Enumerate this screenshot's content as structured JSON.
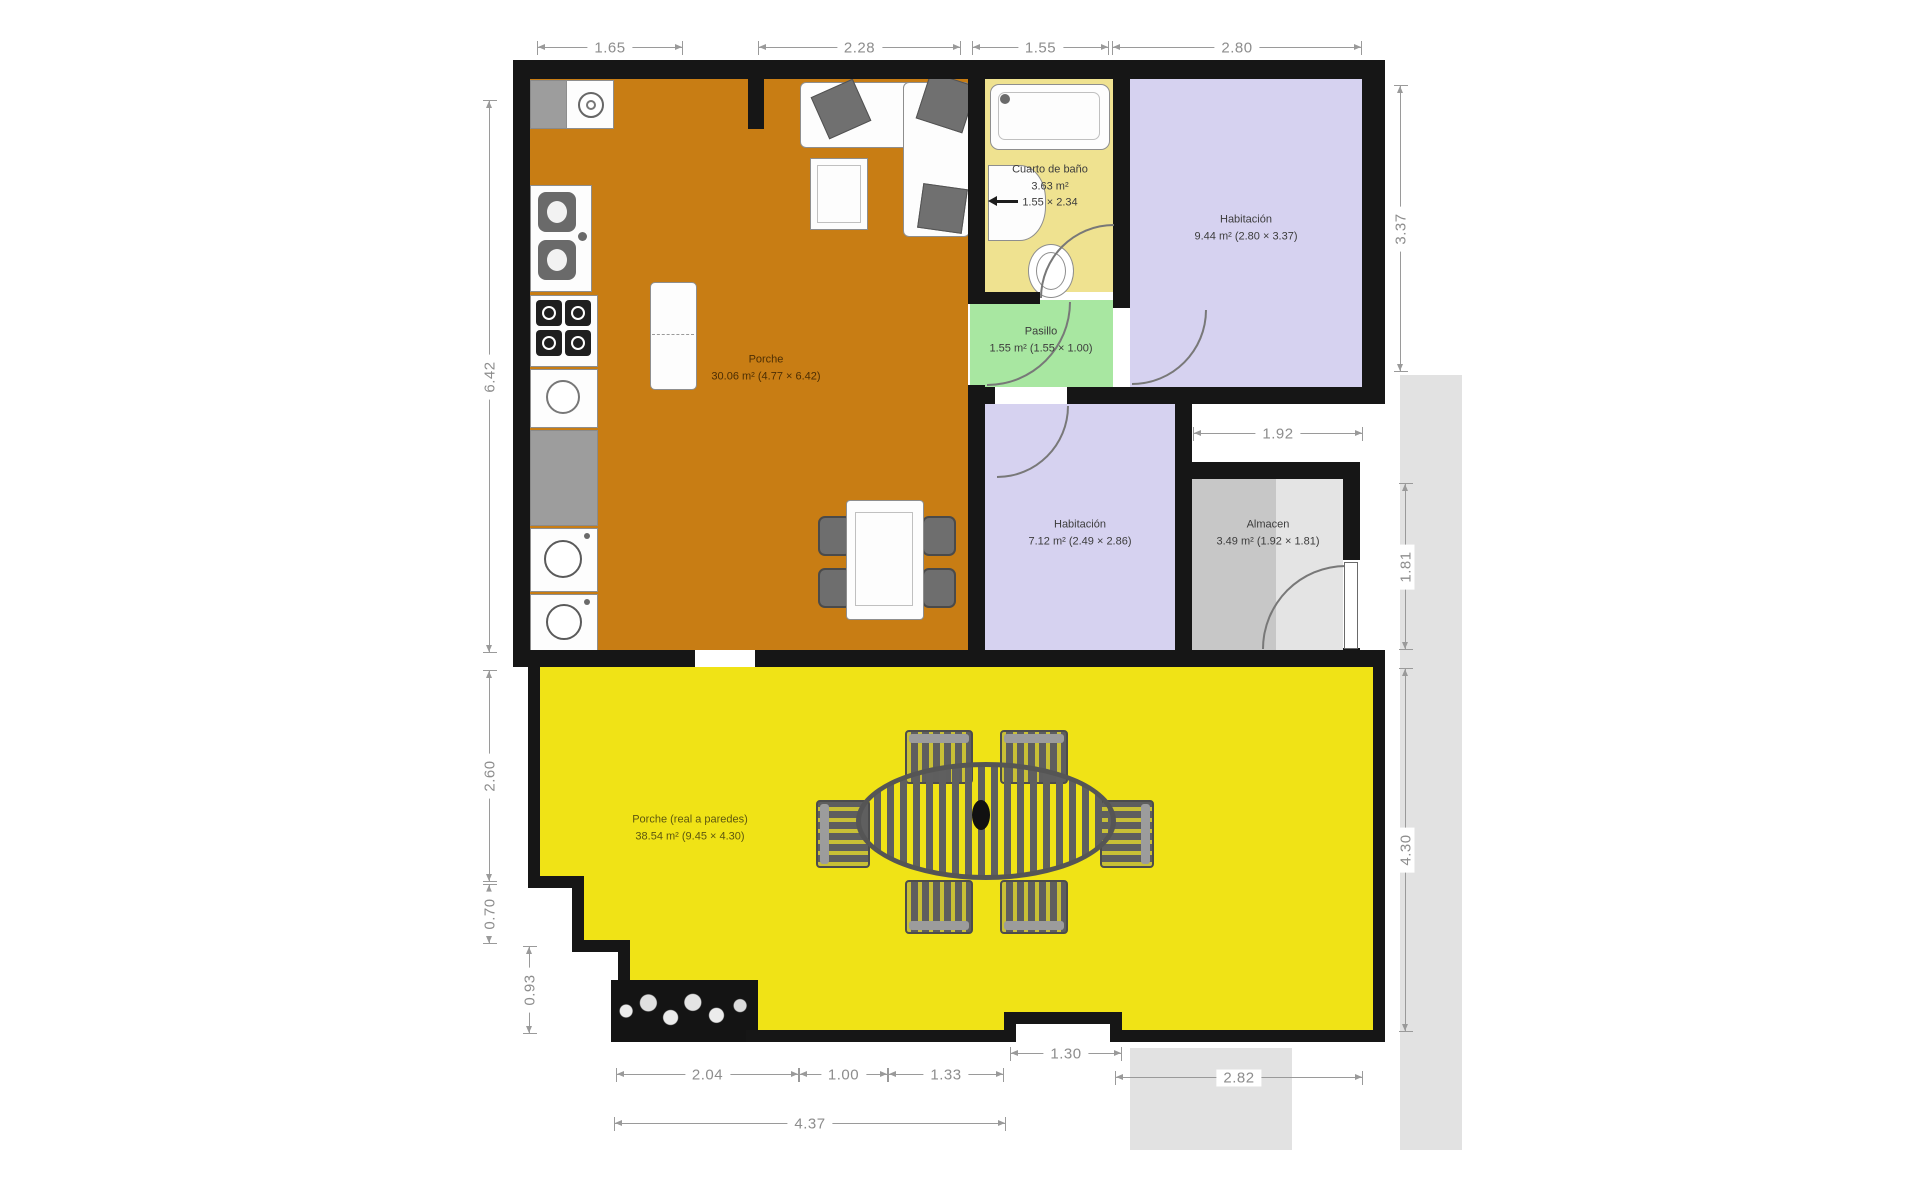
{
  "plan_title": "Floor plan",
  "rooms": {
    "bathroom": {
      "name": "Cuarto de baño",
      "area": "3.63 m²",
      "size": "1.55 × 2.34"
    },
    "bedroom1": {
      "name": "Habitación",
      "detail": "9.44 m² (2.80 × 3.37)"
    },
    "hallway": {
      "name": "Pasillo",
      "detail": "1.55 m² (1.55 × 1.00)"
    },
    "porch_indoor": {
      "name": "Porche",
      "detail": "30.06 m² (4.77 × 6.42)"
    },
    "bedroom2": {
      "name": "Habitación",
      "detail": "7.12 m² (2.49 × 2.86)"
    },
    "storage": {
      "name": "Almacen",
      "detail": "3.49 m² (1.92 × 1.81)"
    },
    "porch_outdoor": {
      "name": "Porche (real a paredes)",
      "detail": "38.54 m² (9.45 × 4.30)"
    }
  },
  "dimensions": {
    "top": [
      "1.65",
      "2.28",
      "1.55",
      "2.80"
    ],
    "left": [
      "6.42",
      "2.60",
      "0.70",
      "0.93"
    ],
    "right": [
      "3.37",
      "1.81",
      "4.30"
    ],
    "middle": [
      "1.92"
    ],
    "bottom": [
      "2.04",
      "1.00",
      "1.33",
      "4.37",
      "1.30",
      "2.82"
    ]
  },
  "colors": {
    "wall": "#161616",
    "porch_indoor": "#C87D14",
    "bathroom": "#EFE290",
    "bedroom": "#D6D2F0",
    "hallway": "#A8E7A1",
    "storage_dark": "#C7C7C7",
    "storage_light": "#E4E4E4",
    "porch_outdoor": "#F0E316",
    "exterior": "#E2E2E2",
    "dimension_line": "#9A9A9A"
  }
}
